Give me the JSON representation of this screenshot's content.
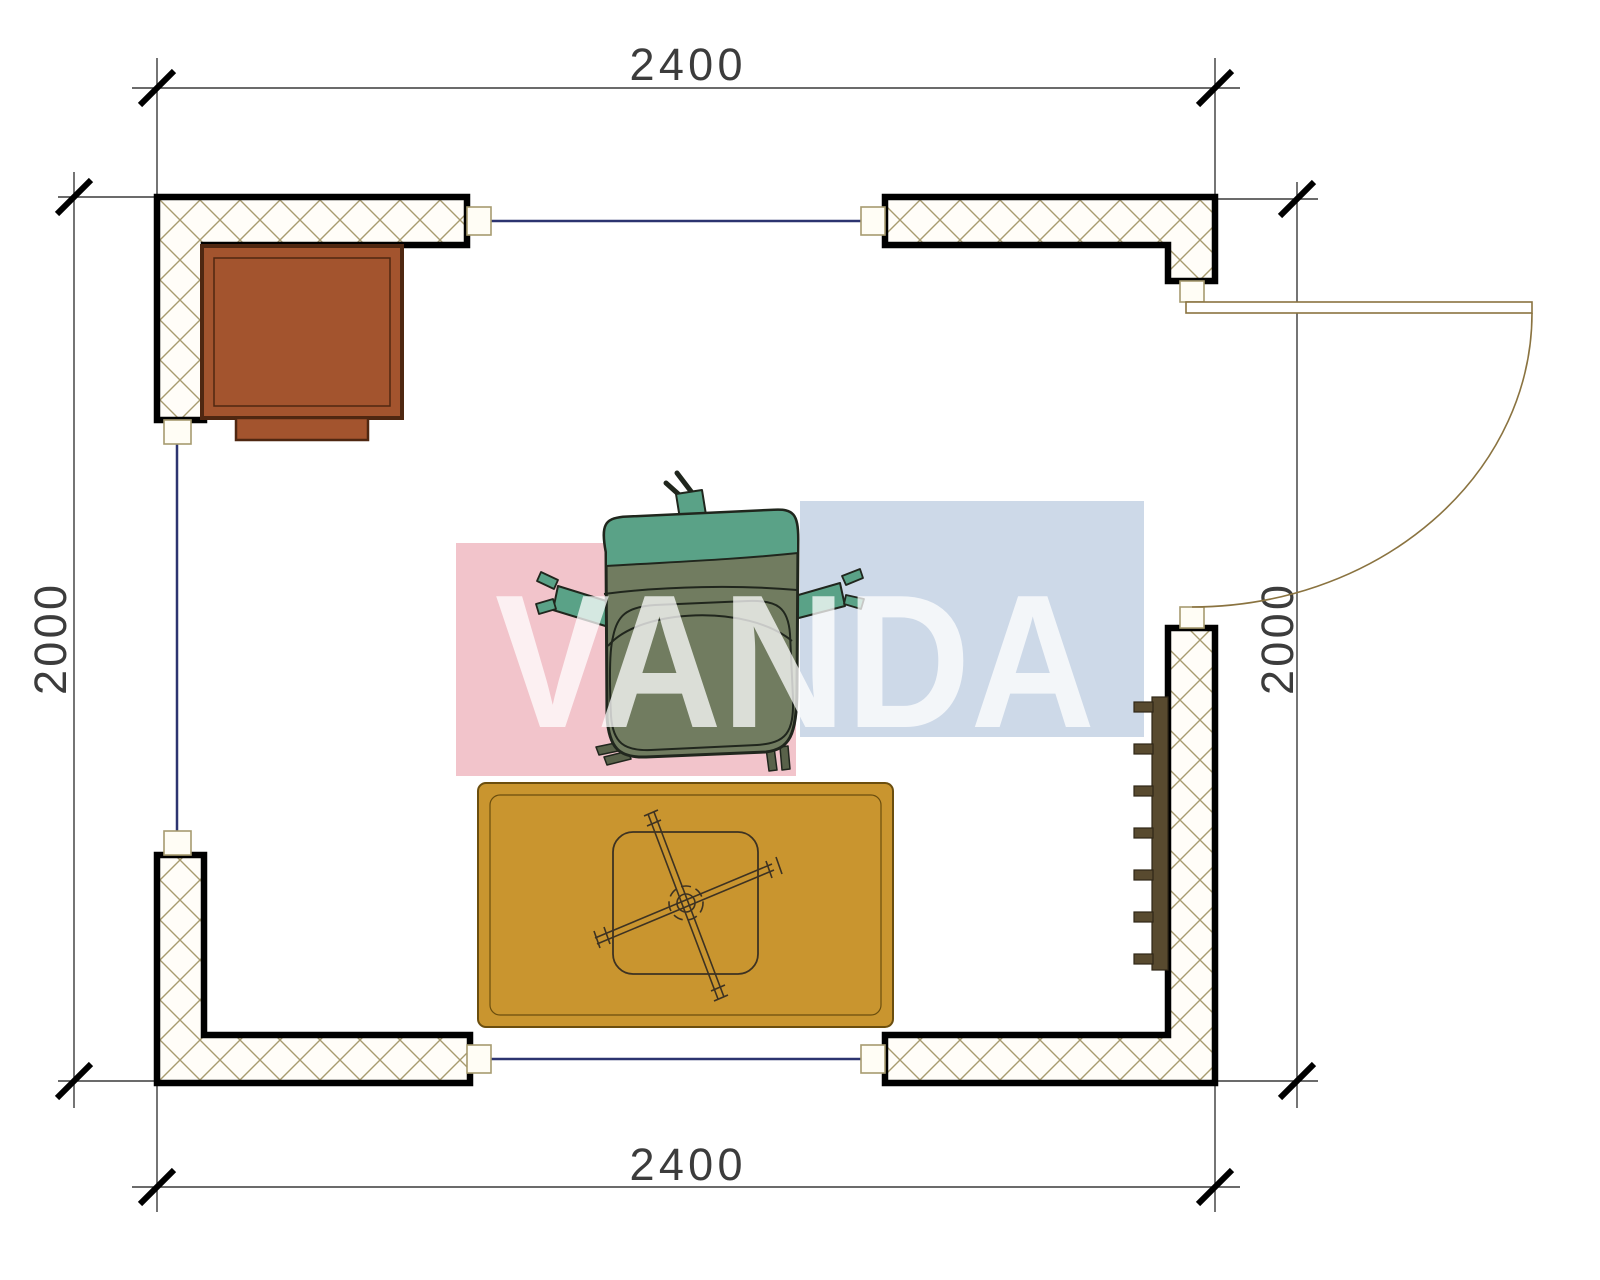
{
  "drawing": {
    "dim_top": "2400",
    "dim_bottom": "2400",
    "dim_left": "2000",
    "dim_right": "2000",
    "watermark_text": "VANDA"
  },
  "colors": {
    "pink_block": "#f2c4cb",
    "blue_block": "#cdd9e8",
    "watermark_text": "#ffffff",
    "wall_outline": "#000000",
    "hatch_line": "#a79b6f",
    "window_line": "#2c3470",
    "door_line": "#8a7340",
    "dimension_line": "#3a3a3a",
    "tick_color": "#000000",
    "desk_fill": "#a3542e",
    "desk_border": "#4f2711",
    "rug_fill": "#c9952f",
    "rug_border": "#6b4e0e",
    "table_line": "#3d3222",
    "chair_teal": "#5aa287",
    "chair_body": "#717c60",
    "chair_outline": "#20261d",
    "chair_feet": "#59624a",
    "radiator_fill": "#584a2f",
    "jamb_fill": "#fffdf5"
  }
}
